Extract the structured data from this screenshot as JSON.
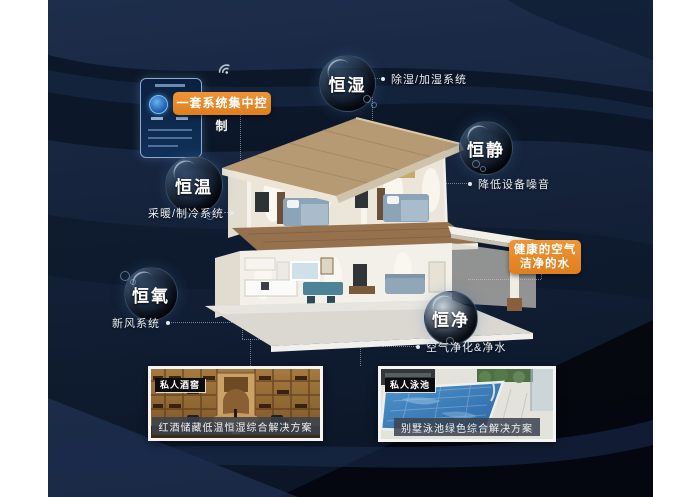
{
  "control_panel": {
    "label": "一套系统集中控制"
  },
  "features": [
    {
      "name": "恒湿",
      "annotation": "除湿/加湿系统"
    },
    {
      "name": "恒静",
      "annotation": "降低设备噪音"
    },
    {
      "name": "恒温",
      "annotation": "采暖/制冷系统"
    },
    {
      "name": "恒氧",
      "annotation": "新风系统"
    },
    {
      "name": "恒净",
      "annotation": "空气净化&净水"
    }
  ],
  "highlight_box": {
    "line1": "健康的空气",
    "line2": "洁净的水"
  },
  "cards": [
    {
      "tag": "私人酒窖",
      "caption": "红酒储藏低温恒湿综合解决方案"
    },
    {
      "tag": "私人泳池",
      "caption": "别墅泳池绿色综合解决方案"
    }
  ],
  "icons": {
    "wifi": "wifi"
  },
  "colors": {
    "accent_orange": "#e6872a",
    "background_navy": "#15233d",
    "caption_bar": "#3c4553",
    "bubble_text": "#ffffff"
  }
}
